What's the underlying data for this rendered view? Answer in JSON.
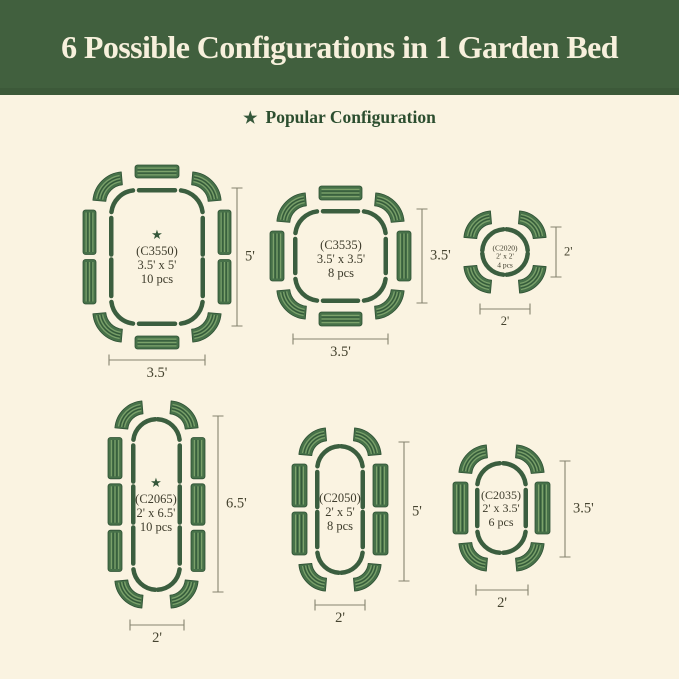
{
  "header": {
    "title": "6 Possible Configurations in 1 Garden Bed"
  },
  "legend": {
    "label": "Popular Configuration"
  },
  "icons": {
    "star": "★"
  },
  "colors": {
    "header_green": "#41603E",
    "banner_text": "#F7F0DC",
    "background": "#FAF3E1",
    "legend_green": "#2C4E2F",
    "star_green": "#35573A",
    "bed_green": "#3B5E3F",
    "panel_green": "#477149",
    "stripe_light": "#7CA26B",
    "stripe_dark": "#2E5134",
    "label_dark": "#3E3C2C",
    "dim_line": "#85836F",
    "dim_text": "#45432F"
  },
  "configs": [
    {
      "code": "(C3550)",
      "size": "3.5' x 5'",
      "pieces": "10 pcs",
      "width_label": "3.5'",
      "height_label": "5'",
      "popular": true
    },
    {
      "code": "(C3535)",
      "size": "3.5' x 3.5'",
      "pieces": "8 pcs",
      "width_label": "3.5'",
      "height_label": "3.5'",
      "popular": false
    },
    {
      "code": "(C2020)",
      "size": "2' x 2'",
      "pieces": "4 pcs",
      "width_label": "2'",
      "height_label": "2'",
      "popular": false
    },
    {
      "code": "(C2065)",
      "size": "2' x 6.5'",
      "pieces": "10 pcs",
      "width_label": "2'",
      "height_label": "6.5'",
      "popular": true
    },
    {
      "code": "(C2050)",
      "size": "2' x 5'",
      "pieces": "8 pcs",
      "width_label": "2'",
      "height_label": "5'",
      "popular": false
    },
    {
      "code": "(C2035)",
      "size": "2' x 3.5'",
      "pieces": "6 pcs",
      "width_label": "2'",
      "height_label": "3.5'",
      "popular": false
    }
  ]
}
